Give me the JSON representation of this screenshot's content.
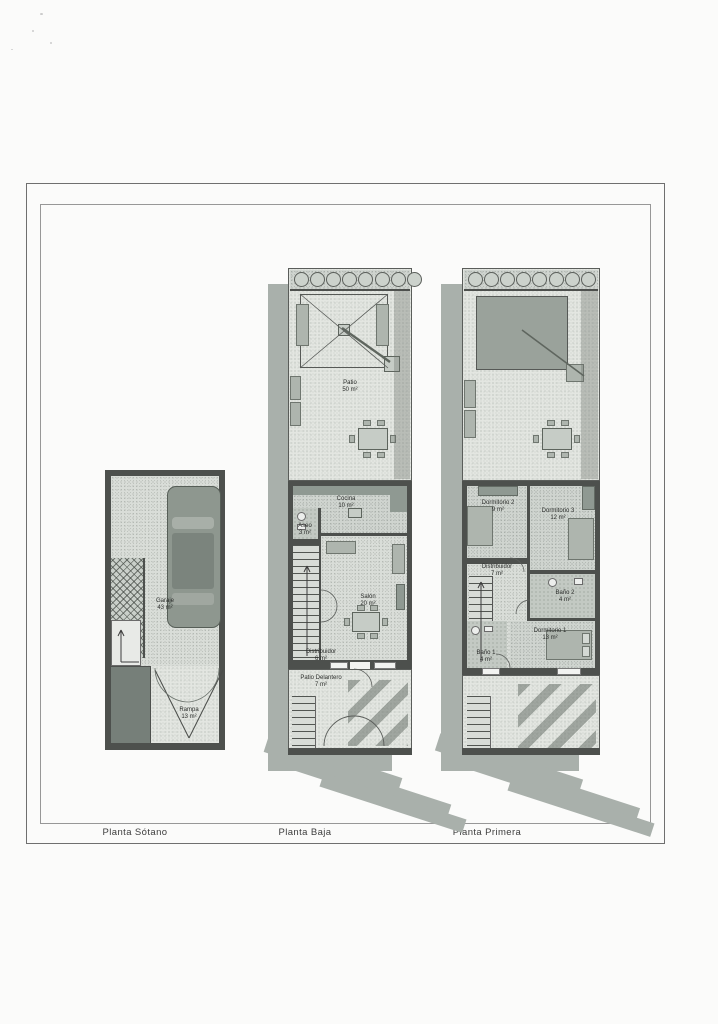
{
  "sheet": {
    "kind": "scanned architectural floor-plan sheet",
    "language": "Spanish"
  },
  "captions": {
    "sotano": "Planta Sótano",
    "baja": "Planta Baja",
    "primera": "Planta Primera"
  },
  "plans": {
    "sotano": {
      "rooms": {
        "garaje": {
          "name": "Garaje",
          "area": "43 m²"
        },
        "rampa": {
          "name": "Rampa",
          "area": "13 m²"
        }
      }
    },
    "baja": {
      "rooms": {
        "patio": {
          "name": "Patio",
          "area": "50 m²"
        },
        "cocina": {
          "name": "Cocina",
          "area": "10 m²"
        },
        "aseo": {
          "name": "Aseo",
          "area": "3 m²"
        },
        "salon": {
          "name": "Salón",
          "area": "20 m²"
        },
        "distribuidor": {
          "name": "Distribuidor",
          "area": "6 m²"
        },
        "patio_delantero": {
          "name": "Patio Delantero",
          "area": "7 m²"
        }
      }
    },
    "primera": {
      "rooms": {
        "dormitorio2": {
          "name": "Dormitorio 2",
          "area": "9 m²"
        },
        "dormitorio3": {
          "name": "Dormitorio 3",
          "area": "12 m²"
        },
        "distribuidor": {
          "name": "Distribuidor",
          "area": "7 m²"
        },
        "bano2": {
          "name": "Baño 2",
          "area": "4 m²"
        },
        "dormitorio1": {
          "name": "Dormitorio 1",
          "area": "13 m²"
        },
        "bano1": {
          "name": "Baño 1",
          "area": "4 m²"
        }
      }
    }
  },
  "colors": {
    "paper": "#fbfbfa",
    "wall": "#4d504d",
    "shadow": "#a9b0ab",
    "floor_light": "#e3e6e1",
    "floor_mid": "#cfd4cf",
    "frame_line": "#6f6f6f"
  }
}
